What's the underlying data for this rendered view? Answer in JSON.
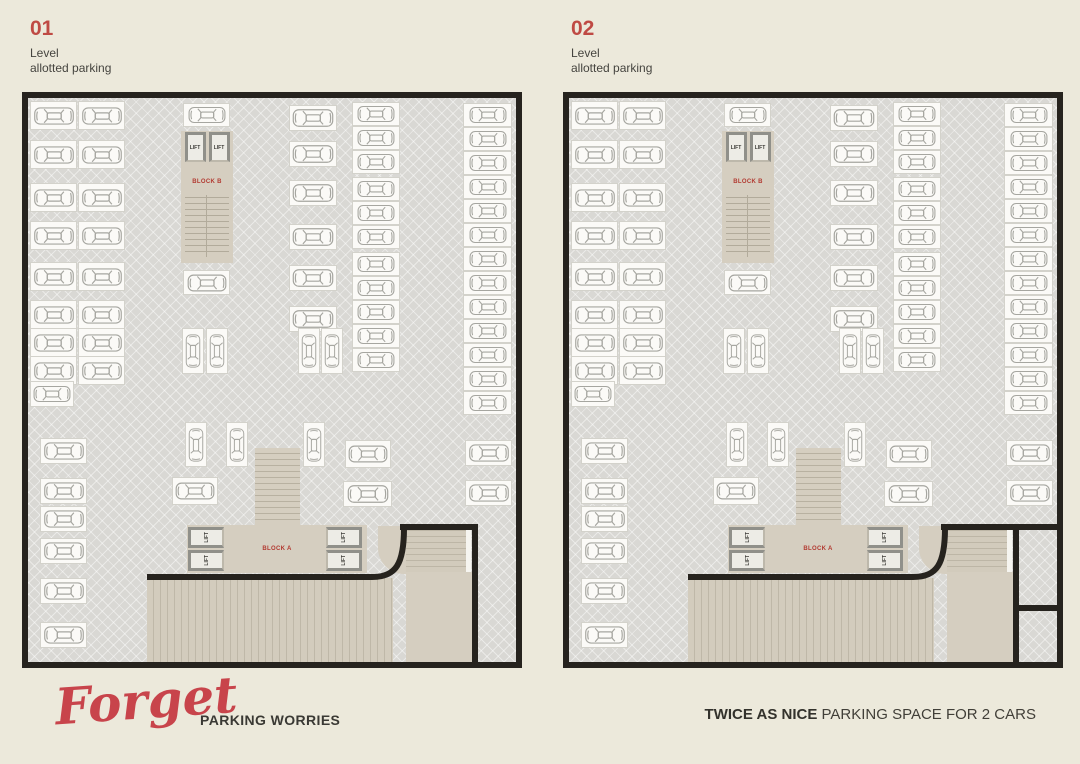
{
  "levels": [
    {
      "number": "01",
      "line1": "Level",
      "line2": "allotted parking",
      "extra_rooms": false
    },
    {
      "number": "02",
      "line1": "Level",
      "line2": "allotted parking",
      "extra_rooms": true
    }
  ],
  "labels": {
    "lift": "LIFT",
    "block_a": "BLOCK A",
    "block_b": "BLOCK B"
  },
  "footer": {
    "script_word": "Forget",
    "left_caption": "PARKING WORRIES",
    "right_bold": "TWICE AS NICE",
    "right_rest": " PARKING SPACE FOR 2 CARS"
  },
  "colors": {
    "page_bg": "#ece9db",
    "accent_red": "#bf4a44",
    "script_red": "#c8444b",
    "floor_gray": "#d9d8d4",
    "building_beige": "#d5cec0",
    "wall_black": "#26231e"
  },
  "plan": {
    "spots": [
      [
        2,
        3,
        47,
        29
      ],
      [
        50,
        3,
        47,
        29
      ],
      [
        2,
        42,
        47,
        29
      ],
      [
        50,
        42,
        47,
        29
      ],
      [
        2,
        85,
        47,
        29
      ],
      [
        50,
        85,
        47,
        29
      ],
      [
        2,
        123,
        47,
        29
      ],
      [
        50,
        123,
        47,
        29
      ],
      [
        2,
        164,
        47,
        29
      ],
      [
        50,
        164,
        47,
        29
      ],
      [
        2,
        202,
        47,
        29
      ],
      [
        50,
        202,
        47,
        29
      ],
      [
        2,
        230,
        47,
        29
      ],
      [
        50,
        230,
        47,
        29
      ],
      [
        2,
        258,
        47,
        29
      ],
      [
        50,
        258,
        47,
        29
      ],
      [
        2,
        283,
        44,
        26
      ],
      [
        12,
        340,
        47,
        26
      ],
      [
        12,
        380,
        47,
        26
      ],
      [
        12,
        408,
        47,
        26
      ],
      [
        12,
        440,
        47,
        26
      ],
      [
        12,
        480,
        47,
        26
      ],
      [
        12,
        524,
        47,
        26
      ],
      [
        155,
        5,
        47,
        24
      ],
      [
        155,
        172,
        47,
        25
      ],
      [
        261,
        7,
        48,
        26
      ],
      [
        261,
        43,
        48,
        26
      ],
      [
        261,
        82,
        48,
        26
      ],
      [
        261,
        126,
        48,
        26
      ],
      [
        261,
        167,
        48,
        26
      ],
      [
        261,
        208,
        48,
        26
      ],
      [
        324,
        4,
        48,
        24
      ],
      [
        324,
        28,
        48,
        24
      ],
      [
        324,
        52,
        48,
        24
      ],
      [
        324,
        79,
        48,
        24
      ],
      [
        324,
        103,
        48,
        24
      ],
      [
        324,
        127,
        48,
        24
      ],
      [
        324,
        154,
        48,
        24
      ],
      [
        324,
        178,
        48,
        24
      ],
      [
        324,
        202,
        48,
        24
      ],
      [
        324,
        226,
        48,
        24
      ],
      [
        324,
        250,
        48,
        24
      ],
      [
        435,
        5,
        49,
        24
      ],
      [
        435,
        29,
        49,
        24
      ],
      [
        435,
        53,
        49,
        24
      ],
      [
        435,
        77,
        49,
        24
      ],
      [
        435,
        101,
        49,
        24
      ],
      [
        435,
        125,
        49,
        24
      ],
      [
        435,
        149,
        49,
        24
      ],
      [
        435,
        173,
        49,
        24
      ],
      [
        435,
        197,
        49,
        24
      ],
      [
        435,
        221,
        49,
        24
      ],
      [
        435,
        245,
        49,
        24
      ],
      [
        435,
        269,
        49,
        24
      ],
      [
        435,
        293,
        49,
        24
      ],
      [
        437,
        342,
        47,
        26
      ],
      [
        437,
        382,
        47,
        26
      ],
      [
        154,
        230,
        22,
        46,
        "v"
      ],
      [
        178,
        230,
        22,
        46,
        "v"
      ],
      [
        270,
        230,
        22,
        46,
        "v"
      ],
      [
        293,
        230,
        22,
        46,
        "v"
      ],
      [
        157,
        324,
        22,
        45,
        "v"
      ],
      [
        198,
        324,
        22,
        45,
        "v"
      ],
      [
        275,
        324,
        22,
        45,
        "v"
      ],
      [
        317,
        342,
        46,
        28
      ],
      [
        144,
        379,
        46,
        28
      ],
      [
        315,
        383,
        49,
        26
      ]
    ]
  }
}
